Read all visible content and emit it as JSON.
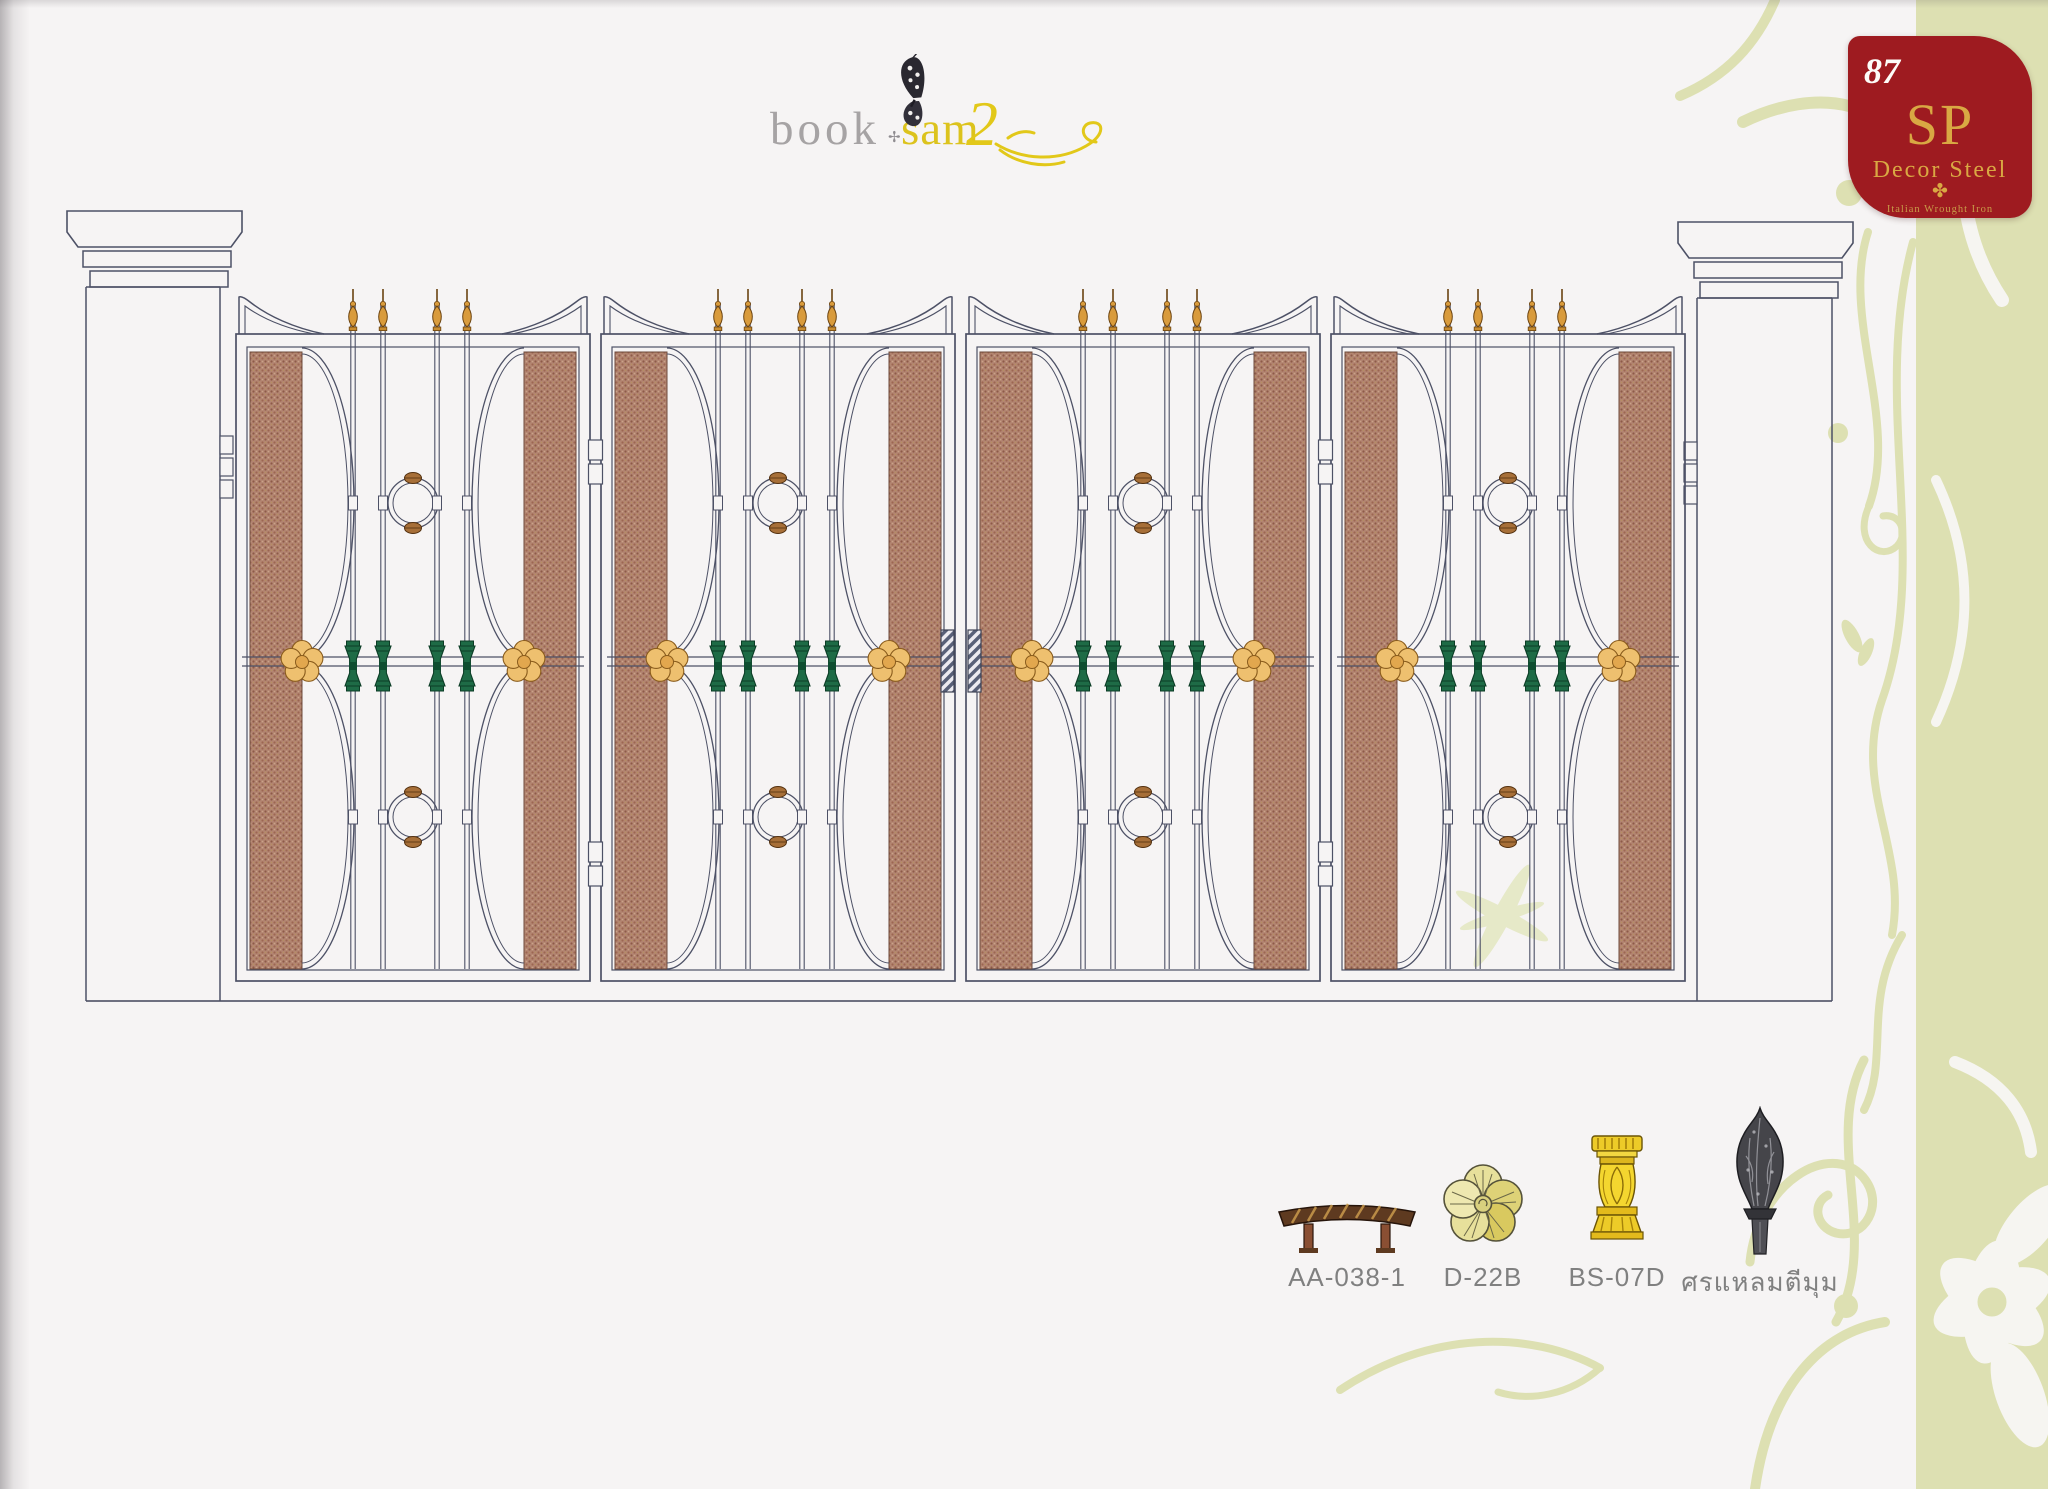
{
  "page": {
    "number": "87",
    "background_color": "#f6f4f4",
    "accent_strip_color": "#dde0b2"
  },
  "logo": {
    "word_book": "book",
    "ornament": "✢",
    "word_sam": "sam",
    "numeral": "2",
    "butterfly_icon": "butterfly",
    "book_color": "#a6a3a4",
    "yellow_color": "#dcc31d"
  },
  "badge": {
    "page_number": "87",
    "initials": "SP",
    "brand_name": "Decor Steel",
    "cross_ornament": "✤",
    "tagline": "Italian Wrought Iron",
    "background_color": "#9e1b20",
    "gold_color": "#d9a843"
  },
  "drawing": {
    "subject": "four-leaf wrought iron gate with masonry pillars",
    "leaf_count": 4,
    "line_color": "#4d5166",
    "panel_color": "#b38571",
    "finial_gold": "#d99b3c",
    "flower_gold": "#eec06f",
    "collar_green": "#1e6b46"
  },
  "legend": {
    "items": [
      {
        "code": "AA-038-1",
        "icon": "twisted-bar"
      },
      {
        "code": "D-22B",
        "icon": "flower-rosette"
      },
      {
        "code": "BS-07D",
        "icon": "baluster-collar"
      },
      {
        "code": "ศรแหลมตีมุม",
        "icon": "spear-finial"
      }
    ],
    "code_color": "#808080"
  }
}
